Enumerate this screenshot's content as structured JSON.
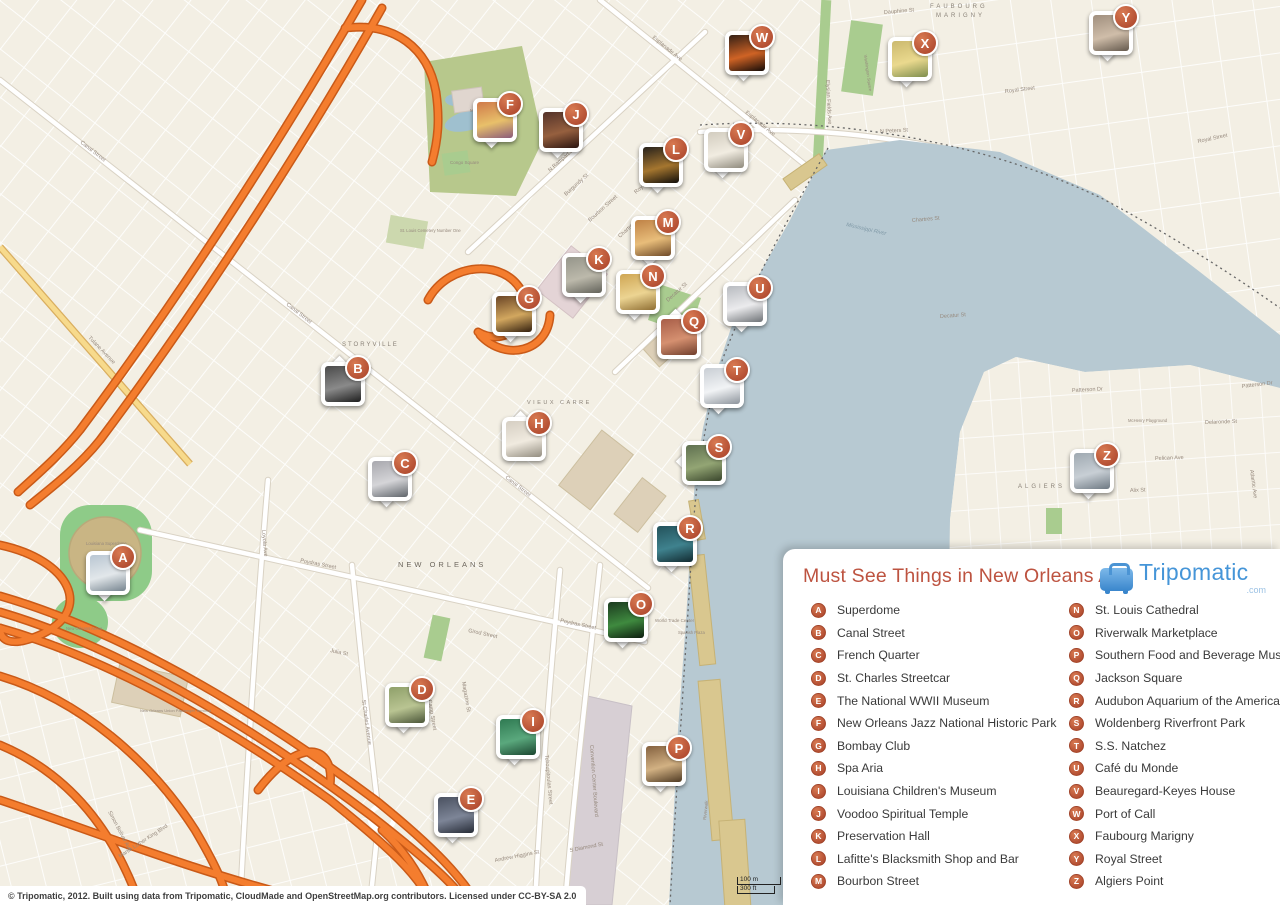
{
  "legend": {
    "title": "Must See Things in New Orleans A-Z",
    "logo": {
      "name": "Tripomatic",
      "tld": ".com"
    },
    "columns": [
      [
        {
          "letter": "A",
          "label": "Superdome"
        },
        {
          "letter": "B",
          "label": "Canal Street"
        },
        {
          "letter": "C",
          "label": "French Quarter"
        },
        {
          "letter": "D",
          "label": "St. Charles Streetcar"
        },
        {
          "letter": "E",
          "label": "The National WWII Museum"
        },
        {
          "letter": "F",
          "label": "New Orleans Jazz National Historic Park"
        },
        {
          "letter": "G",
          "label": "Bombay Club"
        },
        {
          "letter": "H",
          "label": "Spa Aria"
        },
        {
          "letter": "I",
          "label": "Louisiana Children's Museum"
        },
        {
          "letter": "J",
          "label": "Voodoo Spiritual Temple"
        },
        {
          "letter": "K",
          "label": "Preservation Hall"
        },
        {
          "letter": "L",
          "label": "Lafitte's Blacksmith Shop and Bar"
        },
        {
          "letter": "M",
          "label": "Bourbon Street"
        }
      ],
      [
        {
          "letter": "N",
          "label": "St. Louis Cathedral"
        },
        {
          "letter": "O",
          "label": "Riverwalk Marketplace"
        },
        {
          "letter": "P",
          "label": "Southern Food and Beverage Museum"
        },
        {
          "letter": "Q",
          "label": "Jackson Square"
        },
        {
          "letter": "R",
          "label": "Audubon Aquarium of the Americas"
        },
        {
          "letter": "S",
          "label": "Woldenberg Riverfront Park"
        },
        {
          "letter": "T",
          "label": "S.S. Natchez"
        },
        {
          "letter": "U",
          "label": "Café du Monde"
        },
        {
          "letter": "V",
          "label": "Beauregard-Keyes House"
        },
        {
          "letter": "W",
          "label": "Port of Call"
        },
        {
          "letter": "X",
          "label": "Faubourg Marigny"
        },
        {
          "letter": "Y",
          "label": "Royal Street"
        },
        {
          "letter": "Z",
          "label": "Algiers Point"
        }
      ]
    ]
  },
  "attribution": "© Tripomatic, 2012. Built using data from Tripomatic, CloudMade and OpenStreetMap.org contributors. Licensed under CC-BY-SA 2.0",
  "scale_bar": {
    "metric": "100 m",
    "imperial": "300 ft"
  },
  "map": {
    "colors": {
      "land": "#f3efe4",
      "water": "#b7c9d2",
      "park": "#a9cc8f",
      "park_olive": "#b7c88c",
      "highway": "#f47d2e",
      "highway_casing": "#c95a18",
      "yellow_road": "#f7da8c",
      "road": "#ffffff",
      "building_tan": "#ddd0b8",
      "building_pink": "#e4d4d6",
      "wharf": "#d9c78f",
      "dome": "#c9b584",
      "dome_ring": "#8ecb88",
      "marker": "#b44f33",
      "title": "#bd5340",
      "logo_blue": "#4595d8"
    },
    "markers": [
      {
        "letter": "A",
        "x": 123,
        "y": 557,
        "tail": "b",
        "photo": [
          "#b9c6d2",
          "#e2e7ea",
          "#76848f"
        ]
      },
      {
        "letter": "B",
        "x": 358,
        "y": 368,
        "tail": "t",
        "photo": [
          "#4a4a4a",
          "#8a8a8a",
          "#1d1d1d"
        ]
      },
      {
        "letter": "C",
        "x": 405,
        "y": 463,
        "tail": "b",
        "photo": [
          "#a8a8ae",
          "#d5d5d8",
          "#5f646a"
        ]
      },
      {
        "letter": "D",
        "x": 422,
        "y": 689,
        "tail": "b",
        "photo": [
          "#8fa06a",
          "#b9c492",
          "#4a5538"
        ]
      },
      {
        "letter": "E",
        "x": 471,
        "y": 799,
        "tail": "b",
        "photo": [
          "#4a5160",
          "#7d8597",
          "#262b36"
        ]
      },
      {
        "letter": "F",
        "x": 510,
        "y": 104,
        "tail": "b",
        "photo": [
          "#cf7a4a",
          "#e8c06a",
          "#8a5a7a"
        ]
      },
      {
        "letter": "G",
        "x": 529,
        "y": 298,
        "tail": "b",
        "photo": [
          "#6a4526",
          "#d2a75f",
          "#33200f"
        ]
      },
      {
        "letter": "H",
        "x": 539,
        "y": 423,
        "tail": "t",
        "photo": [
          "#d5cec2",
          "#f0eadf",
          "#938d80"
        ]
      },
      {
        "letter": "I",
        "x": 533,
        "y": 721,
        "tail": "b",
        "photo": [
          "#2f7a52",
          "#5aa87d",
          "#1b4630"
        ]
      },
      {
        "letter": "J",
        "x": 576,
        "y": 114,
        "tail": "b",
        "photo": [
          "#54332a",
          "#96603f",
          "#2a1410"
        ]
      },
      {
        "letter": "K",
        "x": 599,
        "y": 259,
        "tail": "b",
        "photo": [
          "#95958a",
          "#bcb9ab",
          "#62625a"
        ]
      },
      {
        "letter": "L",
        "x": 676,
        "y": 149,
        "tail": "b",
        "photo": [
          "#26211b",
          "#a5762f",
          "#100d0a"
        ]
      },
      {
        "letter": "M",
        "x": 668,
        "y": 222,
        "tail": "b",
        "photo": [
          "#bf8246",
          "#e8bd7a",
          "#6f4a28"
        ]
      },
      {
        "letter": "N",
        "x": 653,
        "y": 276,
        "tail": "b",
        "photo": [
          "#cfa654",
          "#ecd492",
          "#8f6e33"
        ]
      },
      {
        "letter": "O",
        "x": 641,
        "y": 604,
        "tail": "b",
        "photo": [
          "#1b3a1e",
          "#3f8a3f",
          "#0d1d0f"
        ]
      },
      {
        "letter": "P",
        "x": 679,
        "y": 748,
        "tail": "b",
        "photo": [
          "#84613f",
          "#d2b183",
          "#4f3a23"
        ]
      },
      {
        "letter": "Q",
        "x": 694,
        "y": 321,
        "tail": "t",
        "photo": [
          "#a85e48",
          "#d59070",
          "#703e2c"
        ]
      },
      {
        "letter": "R",
        "x": 690,
        "y": 528,
        "tail": "b",
        "photo": [
          "#23525b",
          "#3f828e",
          "#122a30"
        ]
      },
      {
        "letter": "S",
        "x": 719,
        "y": 447,
        "tail": "l",
        "photo": [
          "#5f7050",
          "#93a574",
          "#39452c"
        ]
      },
      {
        "letter": "T",
        "x": 737,
        "y": 370,
        "tail": "b",
        "photo": [
          "#c9ced4",
          "#f1f3f5",
          "#8d949c"
        ]
      },
      {
        "letter": "U",
        "x": 760,
        "y": 288,
        "tail": "b",
        "photo": [
          "#b8bbc0",
          "#ebebed",
          "#6e7276"
        ]
      },
      {
        "letter": "V",
        "x": 741,
        "y": 134,
        "tail": "b",
        "photo": [
          "#d2ccbf",
          "#f1ece1",
          "#8f8a7d"
        ]
      },
      {
        "letter": "W",
        "x": 762,
        "y": 37,
        "tail": "b",
        "photo": [
          "#332015",
          "#cf6325",
          "#140b08"
        ]
      },
      {
        "letter": "X",
        "x": 925,
        "y": 43,
        "tail": "b",
        "photo": [
          "#cbb96e",
          "#ead98e",
          "#7e8e4e"
        ]
      },
      {
        "letter": "Y",
        "x": 1126,
        "y": 17,
        "tail": "b",
        "photo": [
          "#a08f7e",
          "#cfbda9",
          "#64594d"
        ]
      },
      {
        "letter": "Z",
        "x": 1107,
        "y": 455,
        "tail": "b",
        "photo": [
          "#9fa9b1",
          "#c8cfd5",
          "#6e7983"
        ]
      }
    ],
    "labels": [
      {
        "text": "NEW ORLEANS",
        "x": 398,
        "y": 567,
        "rot": 0,
        "size": 7.5,
        "ls": 3,
        "color": "#6d675e"
      },
      {
        "text": "STORYVILLE",
        "x": 342,
        "y": 346,
        "rot": 0,
        "size": 6,
        "ls": 2,
        "color": "#8a8278"
      },
      {
        "text": "VIEUX CARRE",
        "x": 527,
        "y": 404,
        "rot": 0,
        "size": 5.5,
        "ls": 2.5,
        "color": "#8a8278"
      },
      {
        "text": "FAUBOURG",
        "x": 930,
        "y": 8,
        "rot": 0,
        "size": 6,
        "ls": 3,
        "color": "#8a8278"
      },
      {
        "text": "MARIGNY",
        "x": 936,
        "y": 17,
        "rot": 0,
        "size": 6,
        "ls": 3,
        "color": "#8a8278"
      },
      {
        "text": "ALGIERS",
        "x": 1018,
        "y": 488,
        "rot": 0,
        "size": 6,
        "ls": 3,
        "color": "#8a8278"
      },
      {
        "text": "Mississippi River",
        "x": 846,
        "y": 226,
        "rot": 13,
        "size": 5.5,
        "italic": true,
        "color": "#7f98a6"
      },
      {
        "text": "Canal Street",
        "x": 80,
        "y": 143,
        "rot": 38
      },
      {
        "text": "Canal Street",
        "x": 286,
        "y": 305,
        "rot": 38
      },
      {
        "text": "Canal Street",
        "x": 505,
        "y": 478,
        "rot": 38
      },
      {
        "text": "Esplanade Ave",
        "x": 652,
        "y": 38,
        "rot": 39
      },
      {
        "text": "Esplanade Ave",
        "x": 745,
        "y": 113,
        "rot": 39
      },
      {
        "text": "N Rampart Street",
        "x": 550,
        "y": 172,
        "rot": -42
      },
      {
        "text": "Royal Street",
        "x": 636,
        "y": 194,
        "rot": -42
      },
      {
        "text": "Royal Street",
        "x": 1005,
        "y": 93,
        "rot": -7
      },
      {
        "text": "Royal Street",
        "x": 1198,
        "y": 143,
        "rot": -12
      },
      {
        "text": "Chartres St",
        "x": 620,
        "y": 238,
        "rot": -42
      },
      {
        "text": "Chartres St",
        "x": 912,
        "y": 222,
        "rot": -5
      },
      {
        "text": "Decatur St",
        "x": 668,
        "y": 302,
        "rot": -42
      },
      {
        "text": "Decatur St",
        "x": 940,
        "y": 318,
        "rot": -4
      },
      {
        "text": "Dauphine St",
        "x": 884,
        "y": 14,
        "rot": -5
      },
      {
        "text": "Bourbon Street",
        "x": 590,
        "y": 222,
        "rot": -42
      },
      {
        "text": "Burgundy St",
        "x": 566,
        "y": 196,
        "rot": -42
      },
      {
        "text": "N Peters St",
        "x": 730,
        "y": 398,
        "rot": -55
      },
      {
        "text": "N Peters St",
        "x": 880,
        "y": 133,
        "rot": -3
      },
      {
        "text": "Poydras Street",
        "x": 300,
        "y": 562,
        "rot": 11
      },
      {
        "text": "Poydras Street",
        "x": 560,
        "y": 622,
        "rot": 12
      },
      {
        "text": "Loyola Ave",
        "x": 262,
        "y": 530,
        "rot": 85
      },
      {
        "text": "Julia St",
        "x": 330,
        "y": 652,
        "rot": 12
      },
      {
        "text": "Girod Street",
        "x": 468,
        "y": 632,
        "rot": 12
      },
      {
        "text": "St Charles Avenue",
        "x": 362,
        "y": 700,
        "rot": 82
      },
      {
        "text": "Camp Street",
        "x": 428,
        "y": 700,
        "rot": 80
      },
      {
        "text": "Magazine St",
        "x": 462,
        "y": 682,
        "rot": 80
      },
      {
        "text": "Tchoupitoulas Street",
        "x": 545,
        "y": 755,
        "rot": 85
      },
      {
        "text": "Convention Center Boulevard",
        "x": 590,
        "y": 745,
        "rot": 86
      },
      {
        "text": "Andrew Higgins St",
        "x": 495,
        "y": 862,
        "rot": -11
      },
      {
        "text": "S Diamond St",
        "x": 570,
        "y": 852,
        "rot": -11
      },
      {
        "text": "Martin Luther King Blvd",
        "x": 120,
        "y": 858,
        "rot": -33
      },
      {
        "text": "Simon Bolivar Ave",
        "x": 108,
        "y": 812,
        "rot": 62
      },
      {
        "text": "Tulane Avenue",
        "x": 88,
        "y": 338,
        "rot": 46
      },
      {
        "text": "Patterson Dr",
        "x": 1072,
        "y": 392,
        "rot": -3
      },
      {
        "text": "Patterson Dr",
        "x": 1242,
        "y": 388,
        "rot": -7
      },
      {
        "text": "Pelican Ave",
        "x": 1155,
        "y": 460,
        "rot": -2
      },
      {
        "text": "Delaronde St",
        "x": 1205,
        "y": 424,
        "rot": -2
      },
      {
        "text": "Alix St",
        "x": 1130,
        "y": 492,
        "rot": -2
      },
      {
        "text": "Atlantic Ave",
        "x": 1250,
        "y": 470,
        "rot": 82
      },
      {
        "text": "Elysian Fields Ave",
        "x": 826,
        "y": 80,
        "rot": 87
      },
      {
        "text": "Municipal Auditorium",
        "x": 470,
        "y": 112,
        "rot": 0,
        "size": 4.5
      },
      {
        "text": "Congo Square",
        "x": 450,
        "y": 164,
        "rot": 0,
        "size": 4.5
      },
      {
        "text": "St. Louis Cemetery Number One",
        "x": 400,
        "y": 232,
        "rot": 0,
        "size": 4.2
      },
      {
        "text": "Louisiana Superdome",
        "x": 86,
        "y": 545,
        "rot": 0,
        "size": 4.2
      },
      {
        "text": "New Orleans Arena",
        "x": 66,
        "y": 630,
        "rot": 0,
        "size": 4.2
      },
      {
        "text": "World Trade Center",
        "x": 655,
        "y": 622,
        "rot": 0,
        "size": 4.5
      },
      {
        "text": "Spanish Plaza",
        "x": 678,
        "y": 634,
        "rot": 0,
        "size": 4.2
      },
      {
        "text": "Riverwalk",
        "x": 706,
        "y": 820,
        "rot": -84,
        "size": 4.5
      },
      {
        "text": "McHenry Playground",
        "x": 1128,
        "y": 422,
        "rot": 0,
        "size": 4.2
      },
      {
        "text": "Washington Square",
        "x": 864,
        "y": 55,
        "rot": 82,
        "size": 4.2
      },
      {
        "text": "New Orleans Union Passenger Terminal",
        "x": 140,
        "y": 712,
        "rot": 0,
        "size": 4
      }
    ]
  }
}
